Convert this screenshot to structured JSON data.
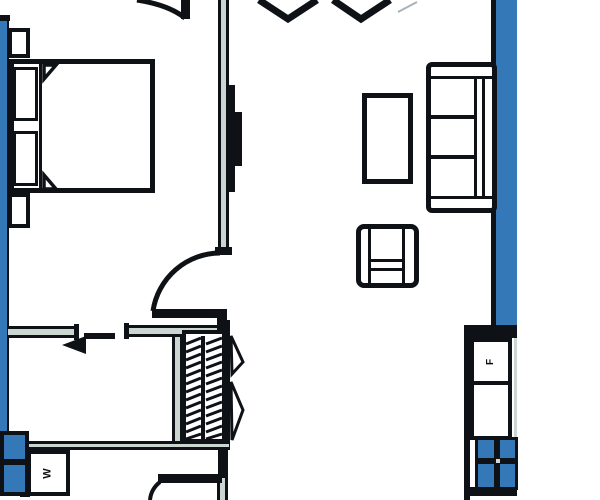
{
  "drawing": {
    "kind": "architectural-floor-plan",
    "orientation": "partial-unit-view"
  },
  "labels": {
    "washer": "W",
    "fridge": "F"
  },
  "colors": {
    "wall_blue": "#3478b7",
    "line": "#0e1116",
    "wall_core": "#ccd6d1",
    "paper": "#ffffff",
    "faint": "#a8b2b8",
    "pane_dot": "#cfd8dc"
  },
  "symbols": [
    "double-bed",
    "pillow",
    "nightstand",
    "door-swing-arc",
    "wall-tv",
    "three-seat-sofa",
    "coffee-table",
    "armchair",
    "closet-hanger-rod",
    "bifold-closet-door",
    "entry-direction-arrow",
    "washer-box",
    "fridge-box",
    "four-pane-fixture",
    "chevron-opening-marks"
  ]
}
